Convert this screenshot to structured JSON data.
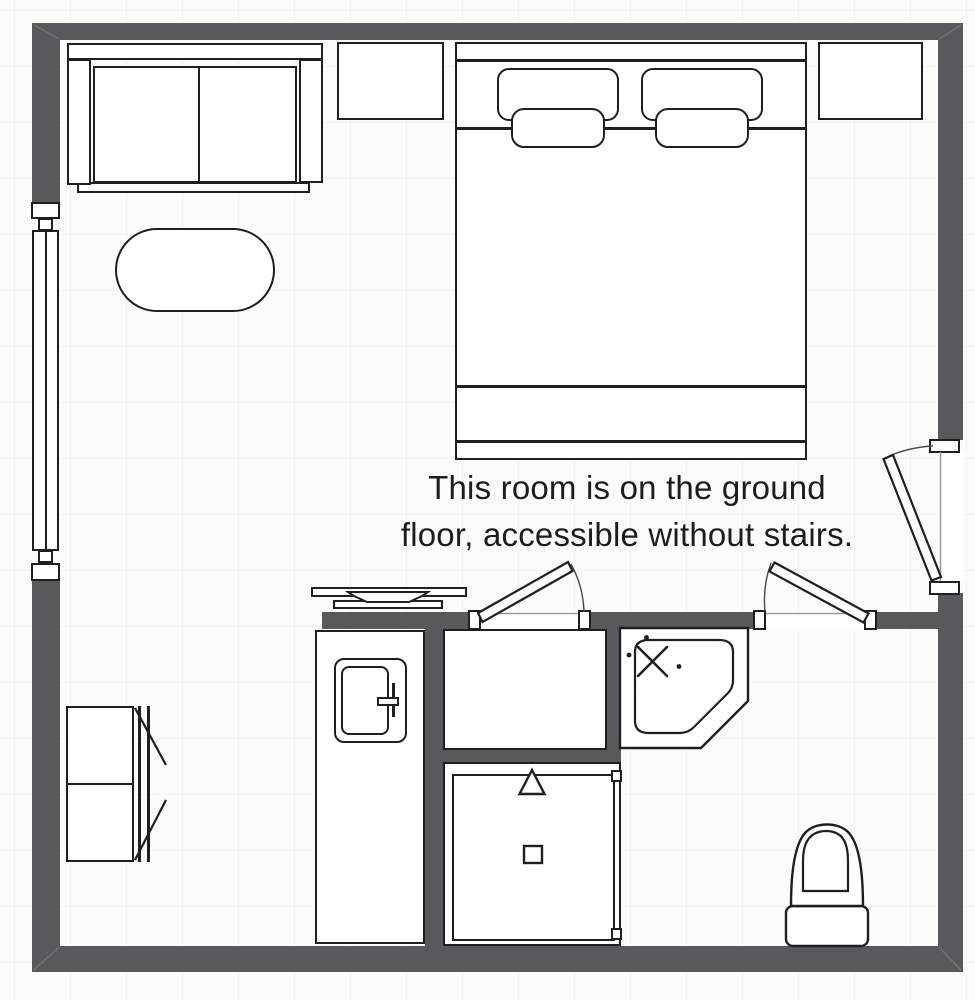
{
  "annotation": {
    "line1": "This room is on the ground",
    "line2": "floor, accessible without stairs."
  },
  "colors": {
    "wall": "#58595b",
    "line": "#1f1f1f",
    "background": "#fbfbf9"
  },
  "legend": {
    "plan_type": "hotel-room-floor-plan",
    "items": [
      "sofa",
      "oval-coffee-table",
      "double-bed",
      "pillows",
      "nightstand-left",
      "nightstand-right",
      "window",
      "entrance-door",
      "vestibule-door",
      "bathroom-door",
      "wardrobe",
      "minibar",
      "shelf-with-plate",
      "tv-with-stand",
      "shower-cabin",
      "corner-shower",
      "toilet"
    ]
  }
}
